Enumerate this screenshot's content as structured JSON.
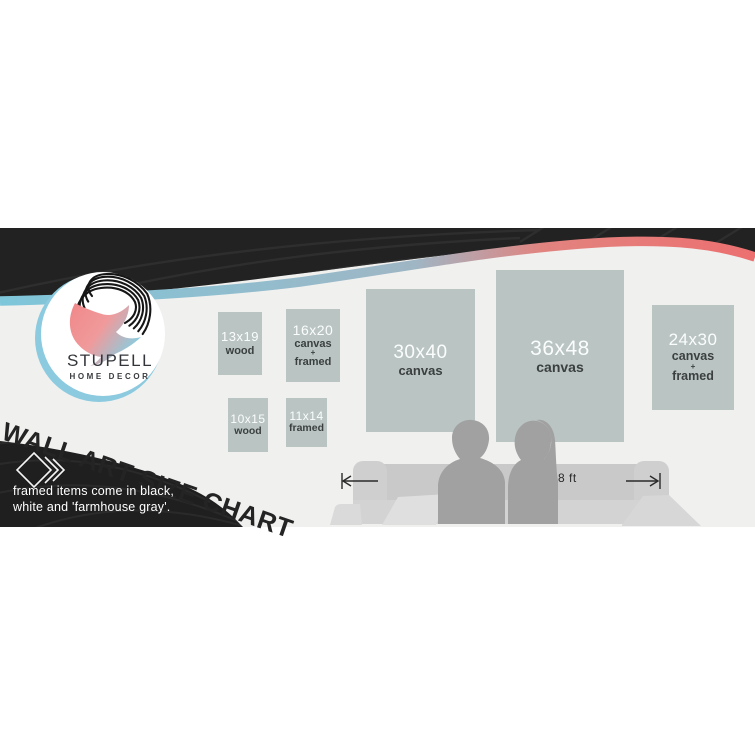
{
  "brand": {
    "name": "STUPELL",
    "tagline": "HOME DECOR"
  },
  "title": "WALL ART SIZE CHART",
  "note": {
    "line1": "framed items come in black,",
    "line2": "white and 'farmhouse gray'."
  },
  "measurement": {
    "label": "8 ft"
  },
  "art_items": [
    {
      "size": "13x19",
      "label1": "wood",
      "label2": "",
      "label3": ""
    },
    {
      "size": "16x20",
      "label1": "canvas",
      "label2": "+",
      "label3": "framed"
    },
    {
      "size": "10x15",
      "label1": "wood",
      "label2": "",
      "label3": ""
    },
    {
      "size": "11x14",
      "label1": "framed",
      "label2": "",
      "label3": ""
    },
    {
      "size": "30x40",
      "label1": "canvas",
      "label2": "",
      "label3": ""
    },
    {
      "size": "36x48",
      "label1": "canvas",
      "label2": "",
      "label3": ""
    },
    {
      "size": "24x30",
      "label1": "canvas",
      "label2": "+",
      "label3": "framed"
    }
  ],
  "colors": {
    "banner_bg": "#f0f0ef",
    "band_black": "#222222",
    "stripe_blue": "#7ec6da",
    "stripe_pink": "#ec7070",
    "box_fill": "#b9c4c3",
    "logo_pink": "#f08a8c",
    "logo_blue": "#7fd2e6",
    "silhouette_gray": "#a1a1a1",
    "couch_gray": "#c9c9c9"
  }
}
